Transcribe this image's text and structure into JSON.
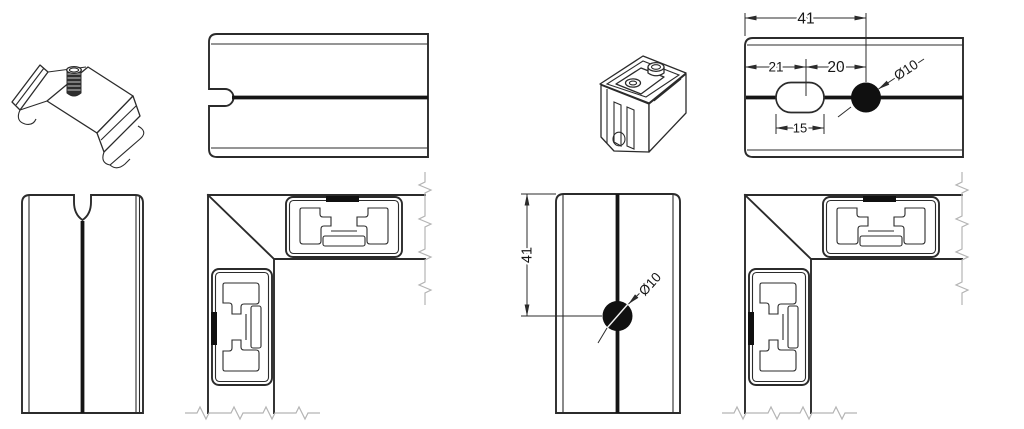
{
  "colors": {
    "background": "#ffffff",
    "line": "#2b2b2b",
    "thick_line": "#151515",
    "break_line": "#b4b4b4",
    "hole_fill": "#101010"
  },
  "dimensions": {
    "top_view": {
      "total_width": "41",
      "edge_to_slot": "21",
      "slot_to_hole": "20",
      "slot_length": "15",
      "hole_diameter": "Ø10"
    },
    "front_view": {
      "edge_to_hole": "41",
      "hole_diameter": "Ø10"
    }
  }
}
